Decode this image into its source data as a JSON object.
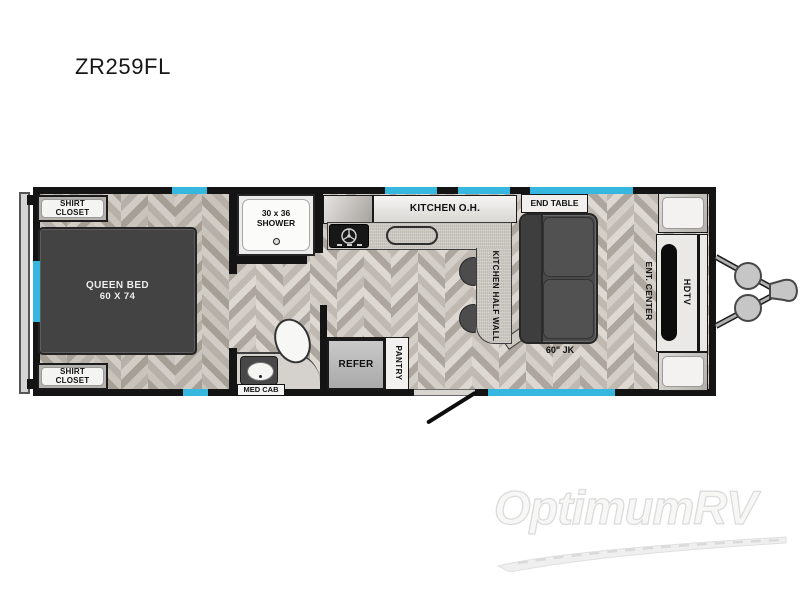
{
  "title": "ZR259FL",
  "floorplan": {
    "bedroom": {
      "shirt_closet": {
        "line1": "SHIRT",
        "line2": "CLOSET"
      },
      "queen_bed": {
        "line1": "QUEEN BED",
        "line2": "60 X 74"
      }
    },
    "bathroom": {
      "shower": {
        "line1": "30 x 36",
        "line2": "SHOWER"
      },
      "med_cab": "MED CAB"
    },
    "kitchen": {
      "overhead": "KITCHEN O.H.",
      "half_wall": "KITCHEN HALF WALL",
      "refer": "REFER",
      "pantry": "PANTRY"
    },
    "living": {
      "end_table": "END TABLE",
      "sofa": "60\" JK",
      "ent_center": "ENT. CENTER",
      "hdtv": "HDTV"
    }
  },
  "watermark": {
    "brand": "OptimumRV"
  },
  "colors": {
    "window_accent": "#35b7e0",
    "wall": "#141414",
    "furniture_dark": "#4a4a4a",
    "floor_light": "#d3cec7",
    "floor_dark": "#ada69e"
  }
}
